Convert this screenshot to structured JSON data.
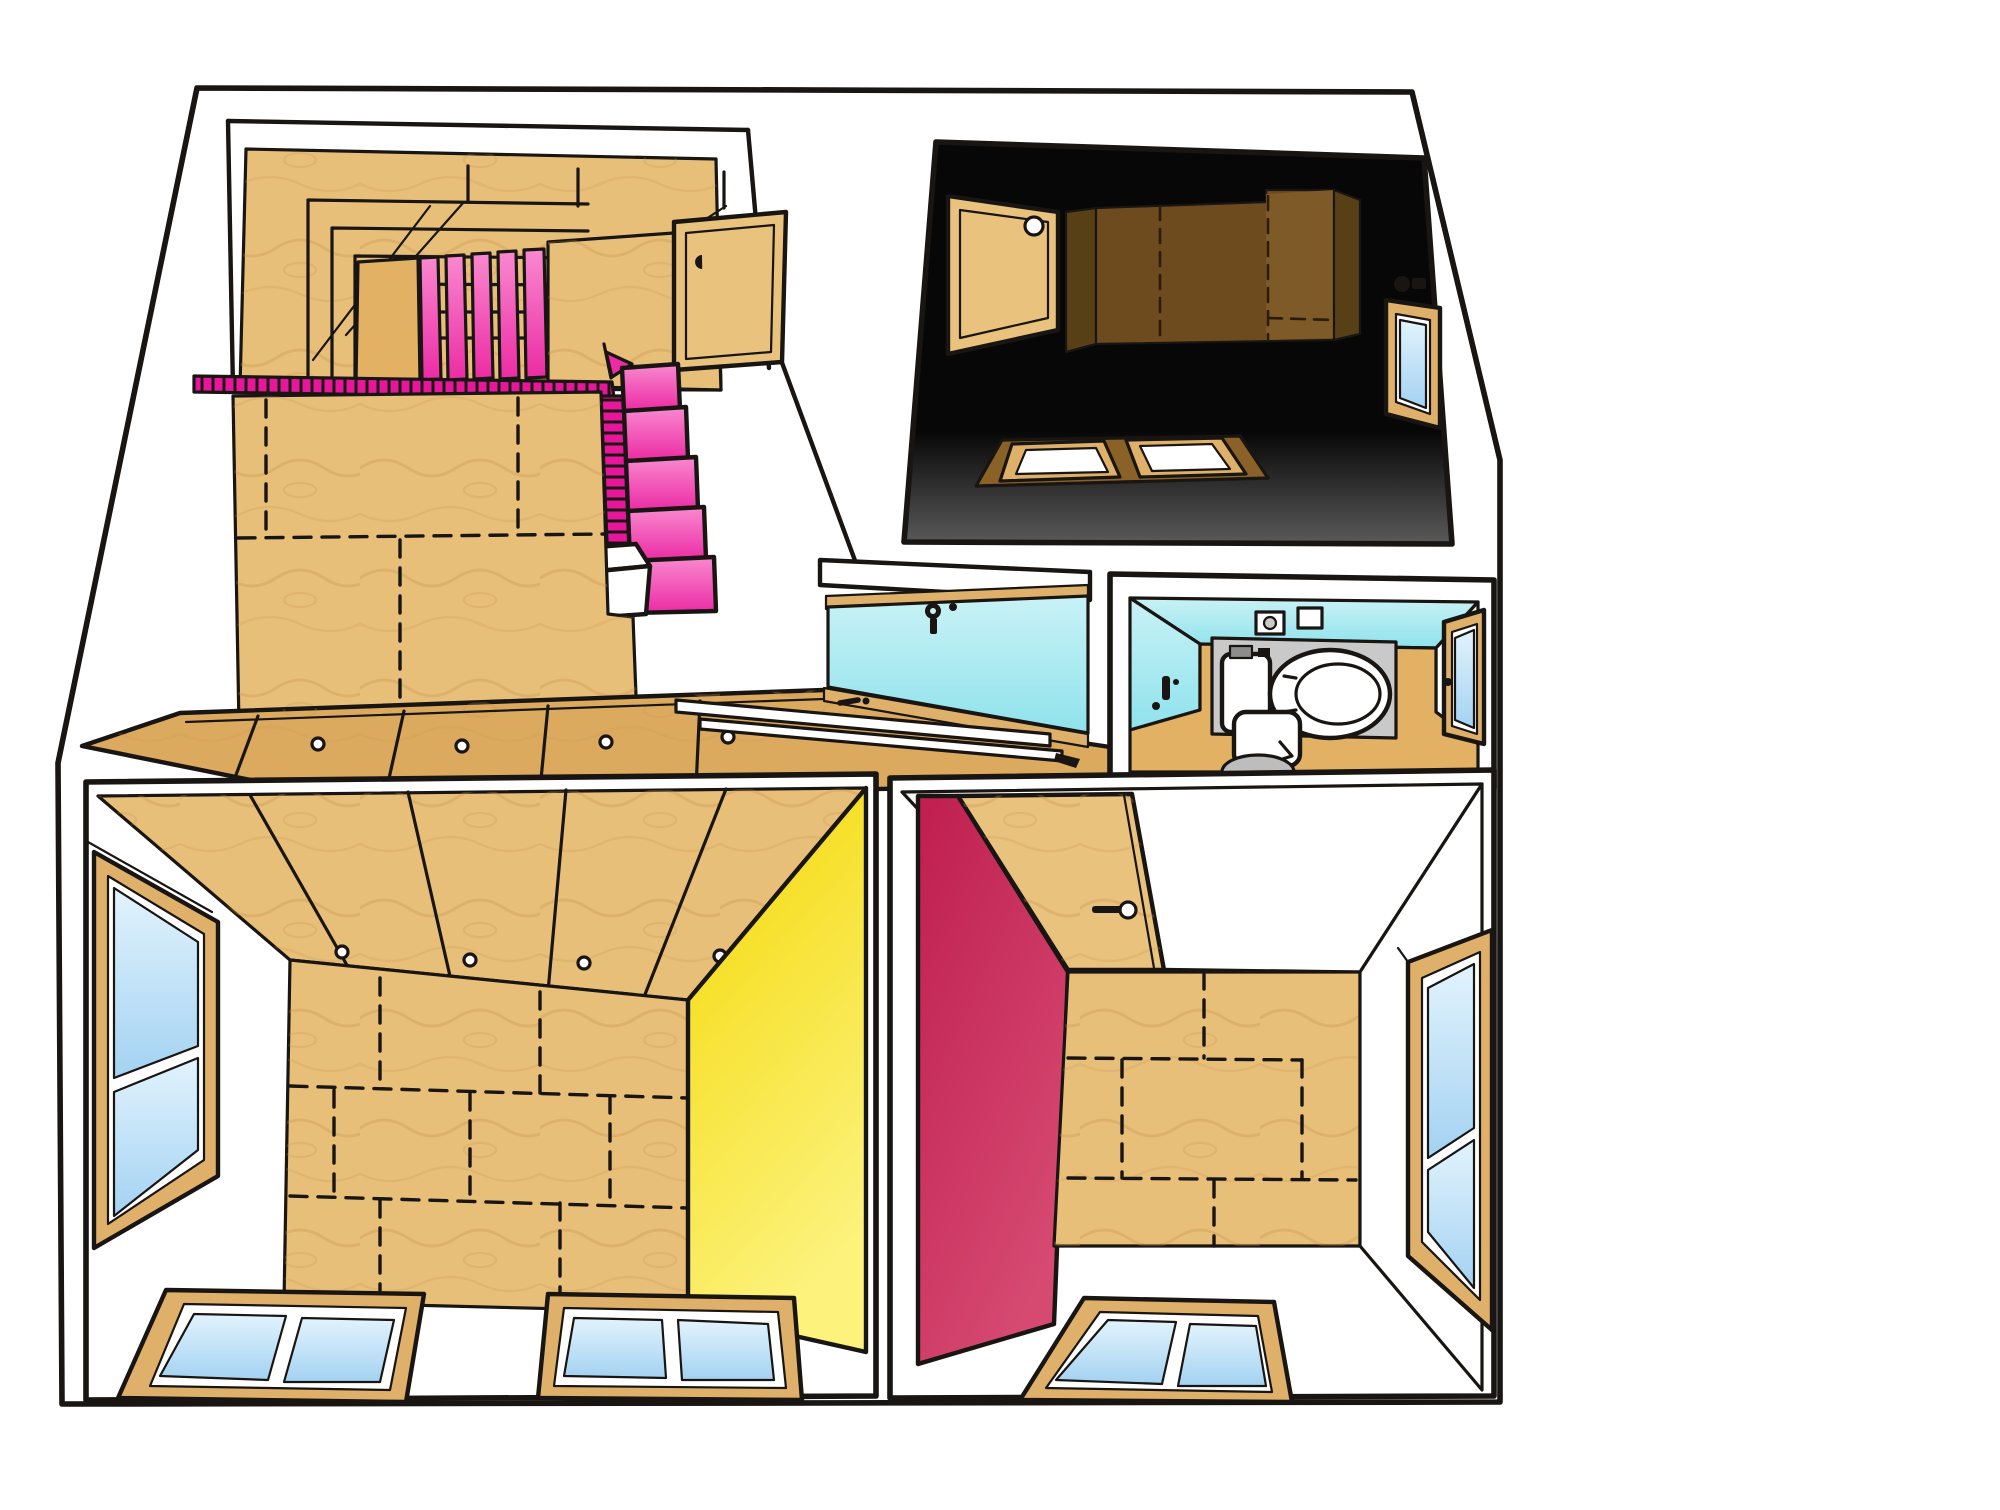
{
  "scene": {
    "description": "Hand-drawn cutaway dollhouse-style illustration of a small house interior; six spaces, no text labels anywhere in the image",
    "background": "#ffffff",
    "ink": "#181512"
  },
  "palette": {
    "white": "#ffffff",
    "plywood": "#e8bf79",
    "plywood_warm": "#e2b164",
    "plywood_floor": "#dcaa5e",
    "wood_frame": "#dfb069",
    "wood_door": "#e9c27d",
    "grain": "#c8924d",
    "pink_rail": "#e7169b",
    "pink_deep": "#ec2ba4",
    "pink_light": "#f989cf",
    "yellow_deep": "#f4d804",
    "yellow_light": "#fcf27c",
    "crimson_deep": "#bf1e4e",
    "crimson_light": "#d64a72",
    "cyan_light": "#c9f2f6",
    "cyan_deep": "#8fe2ec",
    "glass_light": "#e2f3fd",
    "glass_deep": "#a3d2f2",
    "dark_top": "#070707",
    "dark_bottom": "#5a5a5a",
    "dark_wedge": "#584016",
    "dark_panel": "#6e4b1e",
    "dark_panel_light": "#7d5a27",
    "dark_floor": "#8a6228",
    "gray_mat": "#c9c9c9",
    "gray_cap": "#8d8d8d",
    "gray_sink": "#bdbdbd"
  },
  "rooms": [
    {
      "id": "stairwell",
      "label": "Attic stairwell with pink switchback staircase and plywood walls",
      "accent": "#e7169b"
    },
    {
      "id": "dark-bedroom",
      "label": "Dark loft bedroom with plywood headboard panel, wall hatch and window",
      "accent": "#070707"
    },
    {
      "id": "hallway",
      "label": "Landing with sliding glass partition, key in door and floor tracks",
      "accent": "#8fe2ec"
    },
    {
      "id": "bathroom",
      "label": "Toilet room with cyan walls, toilet, window and stool",
      "accent": "#8fe2ec"
    },
    {
      "id": "living-room",
      "label": "Lower room with plywood ceiling and yellow accent wall",
      "accent": "#f4d804"
    },
    {
      "id": "bedroom",
      "label": "Lower room with crimson accent wall, open door and plywood floor",
      "accent": "#bf1e4e"
    }
  ],
  "fixtures": [
    "pink staircase",
    "pink balustrade",
    "newel box",
    "stairwell cupboard",
    "wall hatch with round hole",
    "skylight windows",
    "window lock",
    "sliding glass partition",
    "door key",
    "floor door tracks",
    "toilet with cistern",
    "toilet paper holder",
    "wall box",
    "faucet handle",
    "washlet remote",
    "oval stool",
    "bathroom window",
    "casement window left",
    "double front windows",
    "crimson room door with lever handle",
    "tall right window",
    "double rear window"
  ]
}
